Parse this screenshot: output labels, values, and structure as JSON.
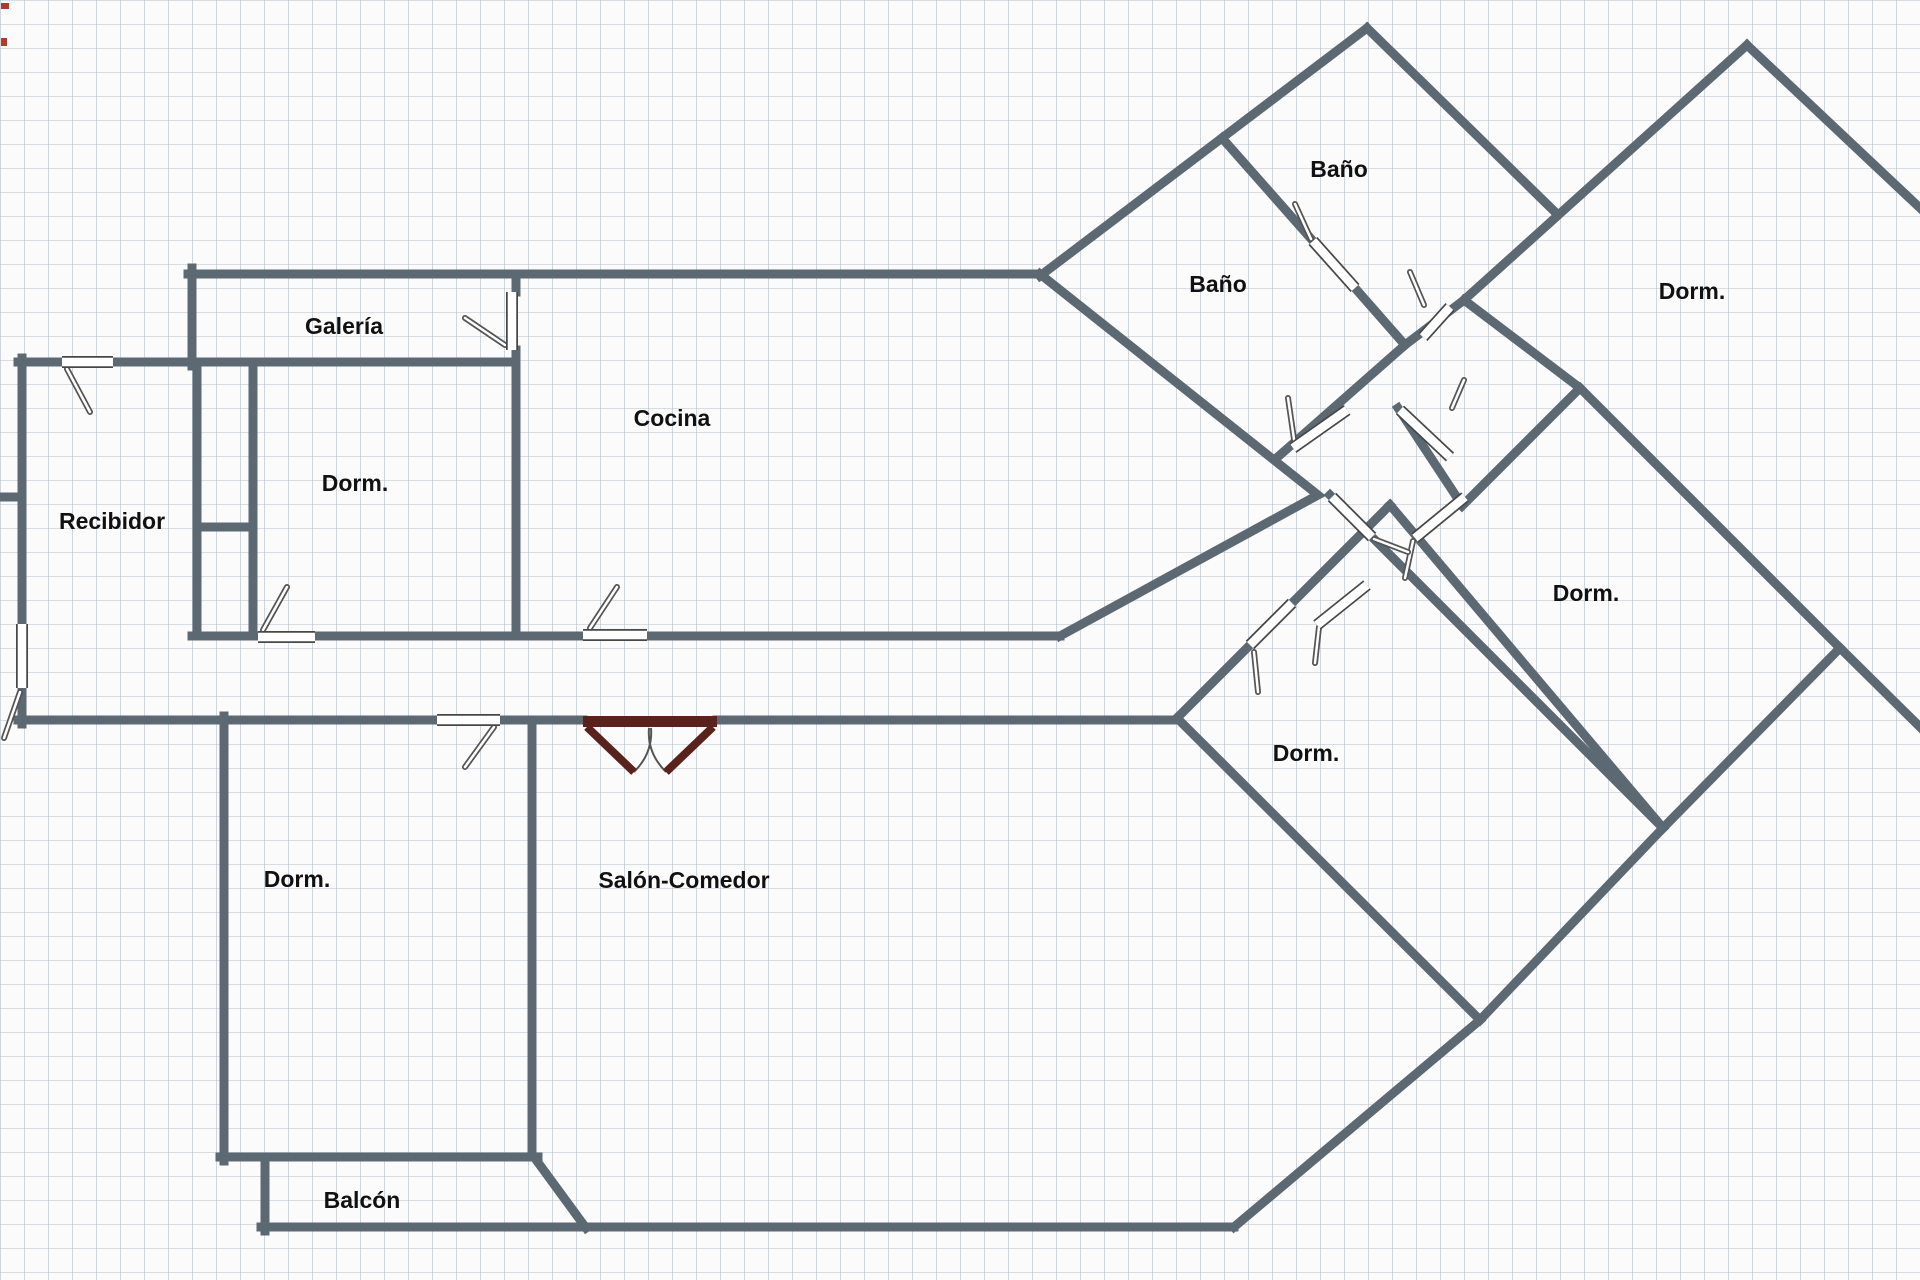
{
  "meta": {
    "title": "Floor plan",
    "canvas": {
      "width": 1920,
      "height": 1280,
      "grid_size": 24
    },
    "colors": {
      "background": "#fbfbfc",
      "grid_line": "rgba(174,184,197,0.55)",
      "wall": "#5c6973",
      "door_leaf_fill": "#ffffff",
      "door_leaf_border": "#474747",
      "door_rod_dark": "#555555",
      "door_rod_light": "#ffffff",
      "entry_door": "#5a221d",
      "swing_arc": "#555555",
      "label_text": "#111111",
      "corner_marks": "#b03a2e"
    },
    "label_font_px": 23
  },
  "rooms": [
    {
      "id": "galeria",
      "label": "Galería",
      "x": 344,
      "y": 328
    },
    {
      "id": "dorm-top-left",
      "label": "Dorm.",
      "x": 355,
      "y": 485
    },
    {
      "id": "recibidor",
      "label": "Recibidor",
      "x": 112,
      "y": 523
    },
    {
      "id": "cocina",
      "label": "Cocina",
      "x": 672,
      "y": 420
    },
    {
      "id": "bano-upper",
      "label": "Baño",
      "x": 1339,
      "y": 171
    },
    {
      "id": "bano-lower",
      "label": "Baño",
      "x": 1218,
      "y": 286
    },
    {
      "id": "dorm-top-right",
      "label": "Dorm.",
      "x": 1692,
      "y": 293
    },
    {
      "id": "dorm-mid-right",
      "label": "Dorm.",
      "x": 1586,
      "y": 595
    },
    {
      "id": "dorm-bottom",
      "label": "Dorm.",
      "x": 1306,
      "y": 755
    },
    {
      "id": "dorm-bottom-left",
      "label": "Dorm.",
      "x": 297,
      "y": 881
    },
    {
      "id": "salon-comedor",
      "label": "Salón-Comedor",
      "x": 684,
      "y": 882
    },
    {
      "id": "balcon",
      "label": "Balcón",
      "x": 362,
      "y": 1202
    }
  ],
  "walls": [
    {
      "name": "wall-galeria-left",
      "points": [
        [
          192,
          268
        ],
        [
          192,
          366
        ]
      ]
    },
    {
      "name": "wall-top",
      "points": [
        [
          188,
          274
        ],
        [
          1040,
          274
        ]
      ]
    },
    {
      "name": "wall-bano-left-edge",
      "points": [
        [
          1040,
          276
        ],
        [
          1367,
          28
        ]
      ]
    },
    {
      "name": "wall-bano-right-edge",
      "points": [
        [
          1367,
          28
        ],
        [
          1554,
          211
        ]
      ]
    },
    {
      "name": "wall-bigdorm-left-edge",
      "points": [
        [
          1747,
          45
        ],
        [
          1464,
          300
        ]
      ]
    },
    {
      "name": "wall-bigdorm-right-edge",
      "points": [
        [
          1747,
          45
        ],
        [
          1920,
          208
        ]
      ]
    },
    {
      "name": "wall-bano-separator-a",
      "points": [
        [
          1222,
          138
        ],
        [
          1313,
          241
        ]
      ]
    },
    {
      "name": "wall-bano-separator-b",
      "points": [
        [
          1355,
          288
        ],
        [
          1405,
          345
        ]
      ]
    },
    {
      "name": "wall-stub-north",
      "points": [
        [
          1405,
          345
        ],
        [
          1464,
          300
        ]
      ]
    },
    {
      "name": "wall-hall-nw",
      "points": [
        [
          1280,
          455
        ],
        [
          1405,
          345
        ]
      ]
    },
    {
      "name": "wall-spine",
      "points": [
        [
          1464,
          300
        ],
        [
          1580,
          388
        ],
        [
          1840,
          648
        ]
      ]
    },
    {
      "name": "wall-exit-right",
      "points": [
        [
          1840,
          648
        ],
        [
          1920,
          727
        ]
      ]
    },
    {
      "name": "wall-middorm-upper-left",
      "points": [
        [
          1580,
          388
        ],
        [
          1462,
          506
        ]
      ]
    },
    {
      "name": "wall-corridor",
      "points": [
        [
          1330,
          495
        ],
        [
          1663,
          828
        ]
      ]
    },
    {
      "name": "wall-middorm-lower-right",
      "points": [
        [
          1840,
          648
        ],
        [
          1663,
          828
        ]
      ]
    },
    {
      "name": "wall-stub-door3",
      "points": [
        [
          1398,
          408
        ],
        [
          1462,
          505
        ]
      ]
    },
    {
      "name": "wall-cocina-wedge",
      "points": [
        [
          1040,
          274
        ],
        [
          1318,
          495
        ],
        [
          1060,
          636
        ]
      ]
    },
    {
      "name": "wall-galeria-right-up",
      "points": [
        [
          516,
          274
        ],
        [
          516,
          292
        ]
      ]
    },
    {
      "name": "wall-galeria-right-down",
      "points": [
        [
          516,
          350
        ],
        [
          516,
          636
        ]
      ]
    },
    {
      "name": "wall-recibidor-top-a",
      "points": [
        [
          18,
          362
        ],
        [
          62,
          362
        ]
      ]
    },
    {
      "name": "wall-recibidor-top-b",
      "points": [
        [
          113,
          362
        ],
        [
          516,
          362
        ]
      ]
    },
    {
      "name": "wall-recibidor-left-a",
      "points": [
        [
          22,
          358
        ],
        [
          22,
          622
        ]
      ]
    },
    {
      "name": "wall-recibidor-left-b",
      "points": [
        [
          22,
          690
        ],
        [
          22,
          724
        ]
      ]
    },
    {
      "name": "wall-left-stub",
      "points": [
        [
          0,
          497
        ],
        [
          22,
          497
        ]
      ]
    },
    {
      "name": "wall-closet-a",
      "points": [
        [
          197,
          362
        ],
        [
          197,
          636
        ]
      ]
    },
    {
      "name": "wall-closet-b",
      "points": [
        [
          253,
          362
        ],
        [
          253,
          636
        ]
      ]
    },
    {
      "name": "wall-closet-stub",
      "points": [
        [
          197,
          527
        ],
        [
          253,
          527
        ]
      ]
    },
    {
      "name": "wall-lower-band-a",
      "points": [
        [
          192,
          636
        ],
        [
          258,
          636
        ]
      ]
    },
    {
      "name": "wall-lower-band-b",
      "points": [
        [
          315,
          636
        ],
        [
          583,
          636
        ]
      ]
    },
    {
      "name": "wall-lower-band-c",
      "points": [
        [
          647,
          636
        ],
        [
          1060,
          636
        ]
      ]
    },
    {
      "name": "wall-hall-bottom-a",
      "points": [
        [
          18,
          720
        ],
        [
          437,
          720
        ]
      ]
    },
    {
      "name": "wall-hall-bottom-b",
      "points": [
        [
          500,
          720
        ],
        [
          583,
          720
        ]
      ]
    },
    {
      "name": "wall-hall-bottom-c",
      "points": [
        [
          717,
          720
        ],
        [
          1177,
          720
        ]
      ]
    },
    {
      "name": "wall-dormbl-left",
      "points": [
        [
          224,
          716
        ],
        [
          224,
          1161
        ]
      ]
    },
    {
      "name": "wall-dormbl-bottom",
      "points": [
        [
          220,
          1157
        ],
        [
          538,
          1157
        ]
      ]
    },
    {
      "name": "wall-salon-separator",
      "points": [
        [
          532,
          724
        ],
        [
          532,
          1157
        ]
      ]
    },
    {
      "name": "wall-chamfer",
      "points": [
        [
          534,
          1157
        ],
        [
          586,
          1228
        ]
      ]
    },
    {
      "name": "wall-balcon-left",
      "points": [
        [
          265,
          1157
        ],
        [
          265,
          1231
        ]
      ]
    },
    {
      "name": "wall-bottom",
      "points": [
        [
          261,
          1227
        ],
        [
          1234,
          1227
        ]
      ]
    },
    {
      "name": "wall-salon-right",
      "points": [
        [
          1177,
          718
        ],
        [
          1480,
          1020
        ]
      ]
    },
    {
      "name": "wall-salon-bottom-right",
      "points": [
        [
          1480,
          1020
        ],
        [
          1234,
          1227
        ]
      ]
    },
    {
      "name": "wall-dormb-upperleft-a",
      "points": [
        [
          1177,
          718
        ],
        [
          1250,
          645
        ]
      ]
    },
    {
      "name": "wall-dormb-upperleft-b",
      "points": [
        [
          1292,
          603
        ],
        [
          1390,
          505
        ]
      ]
    },
    {
      "name": "wall-dormb-upperright",
      "points": [
        [
          1390,
          505
        ],
        [
          1663,
          828
        ]
      ]
    },
    {
      "name": "wall-dormb-lowerright",
      "points": [
        [
          1663,
          828
        ],
        [
          1480,
          1020
        ]
      ]
    }
  ],
  "doors": [
    {
      "name": "door-recibidor-top",
      "leaf": [
        62,
        362,
        113,
        362
      ],
      "rod": [
        67,
        369,
        90,
        412
      ]
    },
    {
      "name": "door-galeria",
      "leaf": [
        512,
        292,
        512,
        350
      ],
      "rod": [
        505,
        345,
        465,
        318
      ]
    },
    {
      "name": "door-recibidor-left",
      "leaf": [
        22,
        624,
        22,
        688
      ],
      "rod": [
        20,
        692,
        4,
        738
      ]
    },
    {
      "name": "door-dorm-tl",
      "leaf": [
        258,
        637,
        315,
        637
      ],
      "rod": [
        263,
        630,
        287,
        587
      ]
    },
    {
      "name": "door-cocina",
      "leaf": [
        583,
        635,
        647,
        635
      ],
      "rod": [
        590,
        628,
        617,
        587
      ]
    },
    {
      "name": "door-hall-dormbl",
      "leaf": [
        437,
        720,
        500,
        720
      ],
      "rod": [
        494,
        727,
        465,
        767
      ]
    },
    {
      "name": "door-bano-sep",
      "leaf": [
        1313,
        241,
        1355,
        288
      ],
      "rod": [
        1311,
        239,
        1295,
        204
      ]
    },
    {
      "name": "door-stub-north",
      "leaf": [
        1423,
        337,
        1450,
        307
      ],
      "rod": [
        1424,
        305,
        1410,
        272
      ]
    },
    {
      "name": "door-hall-nw",
      "leaf": [
        1293,
        448,
        1347,
        410
      ],
      "rod": [
        1295,
        446,
        1288,
        398
      ]
    },
    {
      "name": "door-stub-3",
      "leaf": [
        1400,
        410,
        1450,
        457
      ],
      "rod": [
        1452,
        408,
        1464,
        380
      ]
    },
    {
      "name": "door-middorm",
      "leaf": [
        1415,
        538,
        1465,
        497
      ],
      "rod": [
        1413,
        541,
        1405,
        578
      ]
    },
    {
      "name": "door-center-low",
      "leaf": [
        1317,
        625,
        1367,
        585
      ],
      "rod": [
        1319,
        627,
        1315,
        663
      ]
    },
    {
      "name": "door-dormb",
      "leaf": [
        1250,
        645,
        1292,
        603
      ],
      "rod": [
        1254,
        652,
        1258,
        692
      ]
    },
    {
      "name": "door-corridor",
      "leaf": [
        1332,
        497,
        1372,
        537
      ],
      "rod": [
        1374,
        539,
        1408,
        552
      ]
    }
  ],
  "entry_double_door": {
    "name": "entry-double-door",
    "bar": {
      "x": 583,
      "y": 716,
      "width": 134,
      "height": 11
    },
    "left_leaf": [
      587,
      727,
      634,
      772
    ],
    "right_leaf": [
      713,
      727,
      666,
      772
    ],
    "left_arc": "M 634,772 Q 653,753 651,728",
    "right_arc": "M 666,772 Q 647,753 649,728"
  },
  "corner_marks": [
    {
      "name": "corner-mark-1",
      "x": 1,
      "y": 3,
      "width": 8,
      "height": 6
    },
    {
      "name": "corner-mark-2",
      "x": 1,
      "y": 38,
      "width": 6,
      "height": 8
    }
  ]
}
